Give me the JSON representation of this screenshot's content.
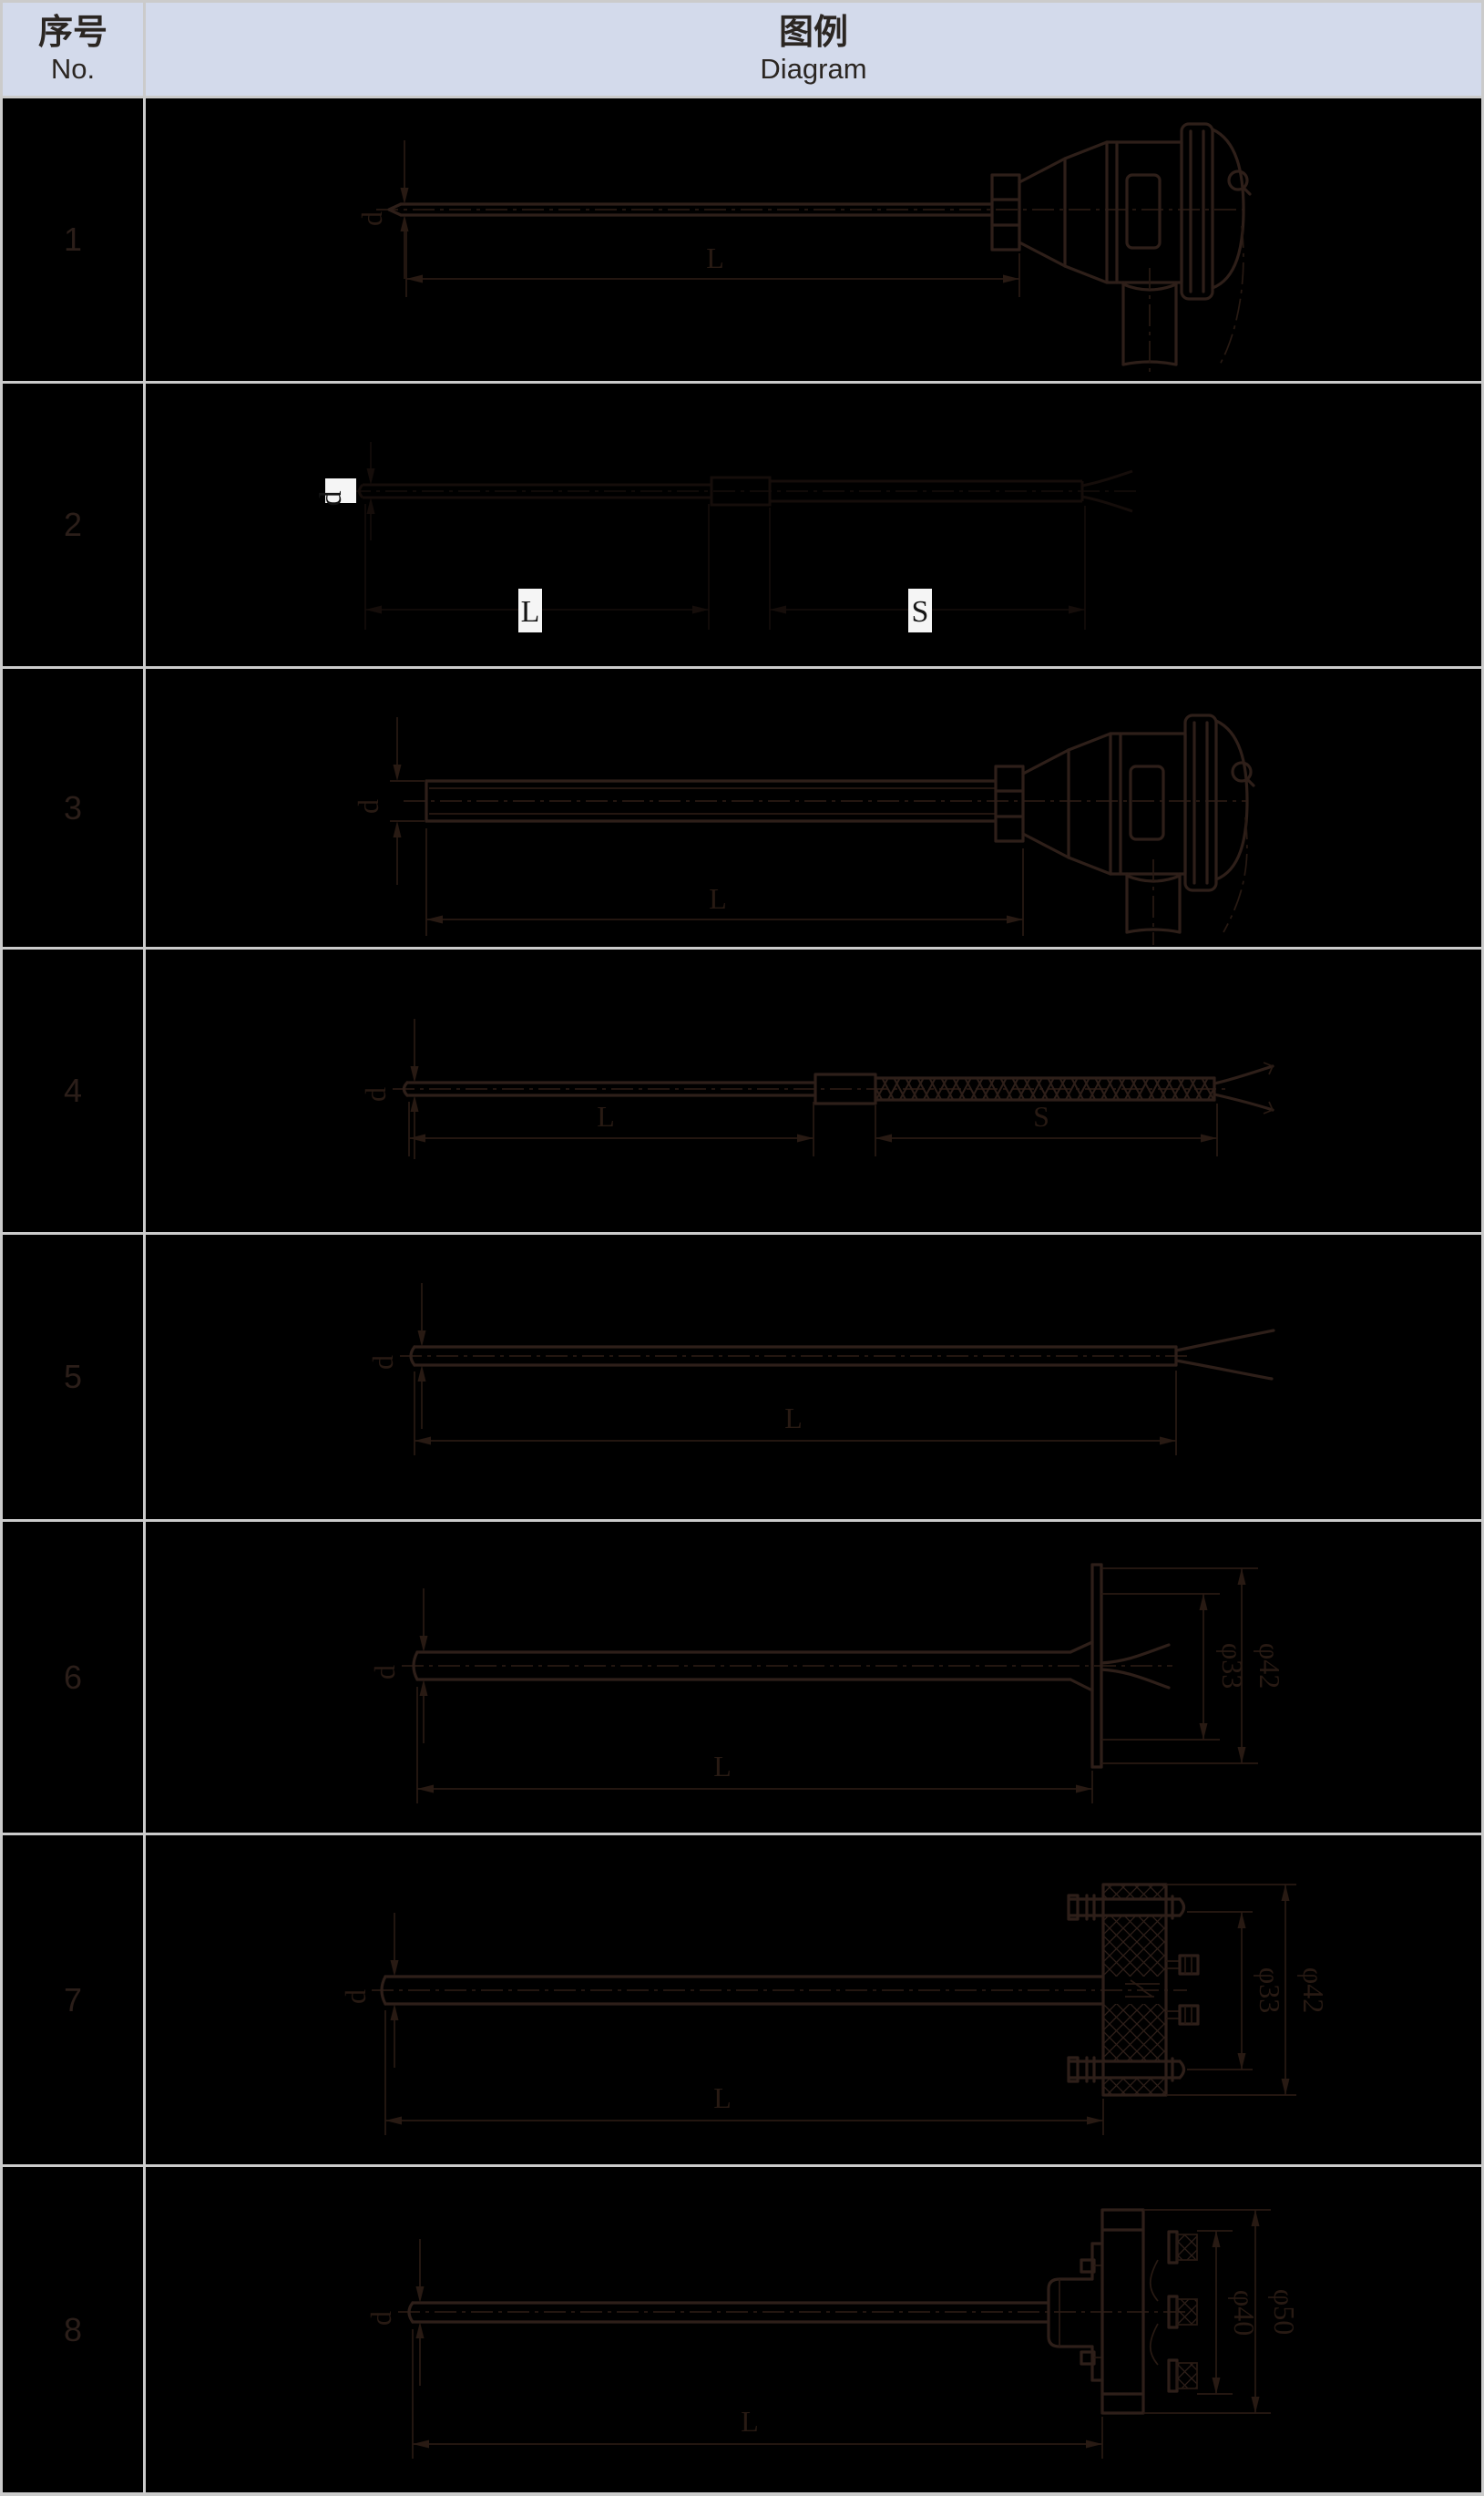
{
  "table": {
    "header": {
      "col_no_zh": "序号",
      "col_no_en": "No.",
      "col_diagram_zh": "图例",
      "col_diagram_en": "Diagram"
    },
    "rows": [
      {
        "no": "1",
        "dims": {
          "d": "d",
          "L": "L"
        }
      },
      {
        "no": "2",
        "dims": {
          "d": "d",
          "L": "L",
          "S": "S"
        }
      },
      {
        "no": "3",
        "dims": {
          "d": "d",
          "L": "L"
        }
      },
      {
        "no": "4",
        "dims": {
          "d": "d",
          "L": "L",
          "S": "S"
        }
      },
      {
        "no": "5",
        "dims": {
          "d": "d",
          "L": "L"
        }
      },
      {
        "no": "6",
        "dims": {
          "d": "d",
          "L": "L",
          "dia_inner": "φ33",
          "dia_outer": "φ42"
        }
      },
      {
        "no": "7",
        "dims": {
          "d": "d",
          "L": "L",
          "dia_inner": "φ33",
          "dia_outer": "φ42"
        }
      },
      {
        "no": "8",
        "dims": {
          "d": "d",
          "L": "L",
          "dia_inner": "φ40",
          "dia_outer": "φ50"
        }
      }
    ]
  },
  "colors": {
    "table_background": "#000000",
    "header_background": "#d3daeb",
    "grid_line": "#cbcbcb",
    "drawing_line": "#2e1f19",
    "dimension_line": "#281a13",
    "faint_line": "#150d0a",
    "label_highlight": "#f5f5f5",
    "header_text": "#2b2622",
    "row_number_text": "#2b1e19"
  }
}
